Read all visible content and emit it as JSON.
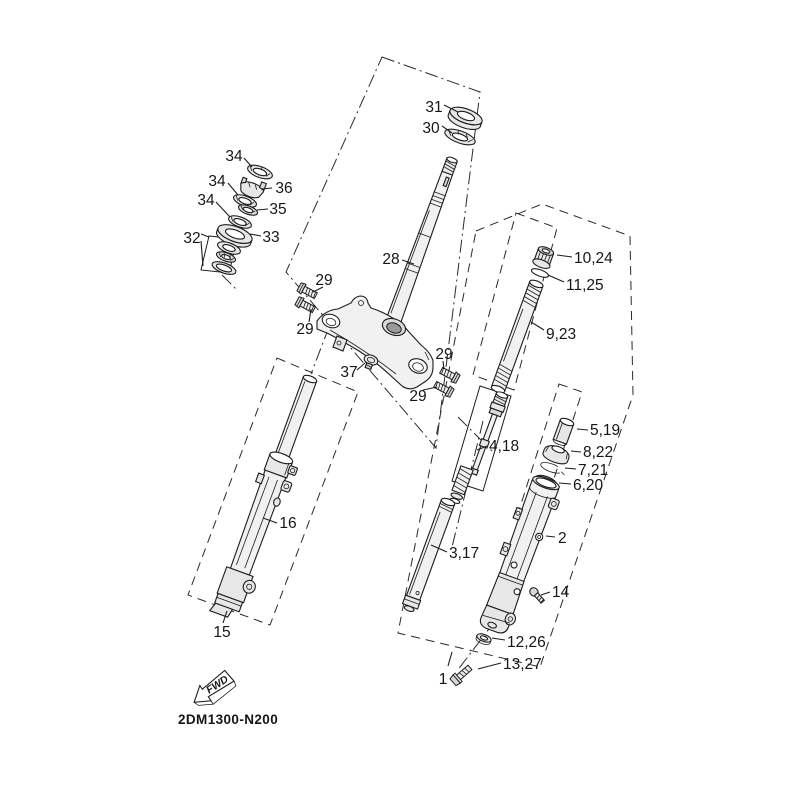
{
  "diagram": {
    "drawing_number": "2DM1300-N200",
    "fwd_label": "FWD",
    "callouts": [
      {
        "text": "31"
      },
      {
        "text": "30"
      },
      {
        "text": "34"
      },
      {
        "text": "34"
      },
      {
        "text": "34"
      },
      {
        "text": "36"
      },
      {
        "text": "35"
      },
      {
        "text": "33"
      },
      {
        "text": "32"
      },
      {
        "text": "28"
      },
      {
        "text": "29"
      },
      {
        "text": "29"
      },
      {
        "text": "29"
      },
      {
        "text": "29"
      },
      {
        "text": "37"
      },
      {
        "text": "10,24"
      },
      {
        "text": "11,25"
      },
      {
        "text": "9,23"
      },
      {
        "text": "4,18"
      },
      {
        "text": "5,19"
      },
      {
        "text": "8,22"
      },
      {
        "text": "7,21"
      },
      {
        "text": "6,20"
      },
      {
        "text": "2"
      },
      {
        "text": "3,17"
      },
      {
        "text": "14"
      },
      {
        "text": "12,26"
      },
      {
        "text": "13,27"
      },
      {
        "text": "16"
      },
      {
        "text": "15"
      },
      {
        "text": "1"
      }
    ]
  }
}
